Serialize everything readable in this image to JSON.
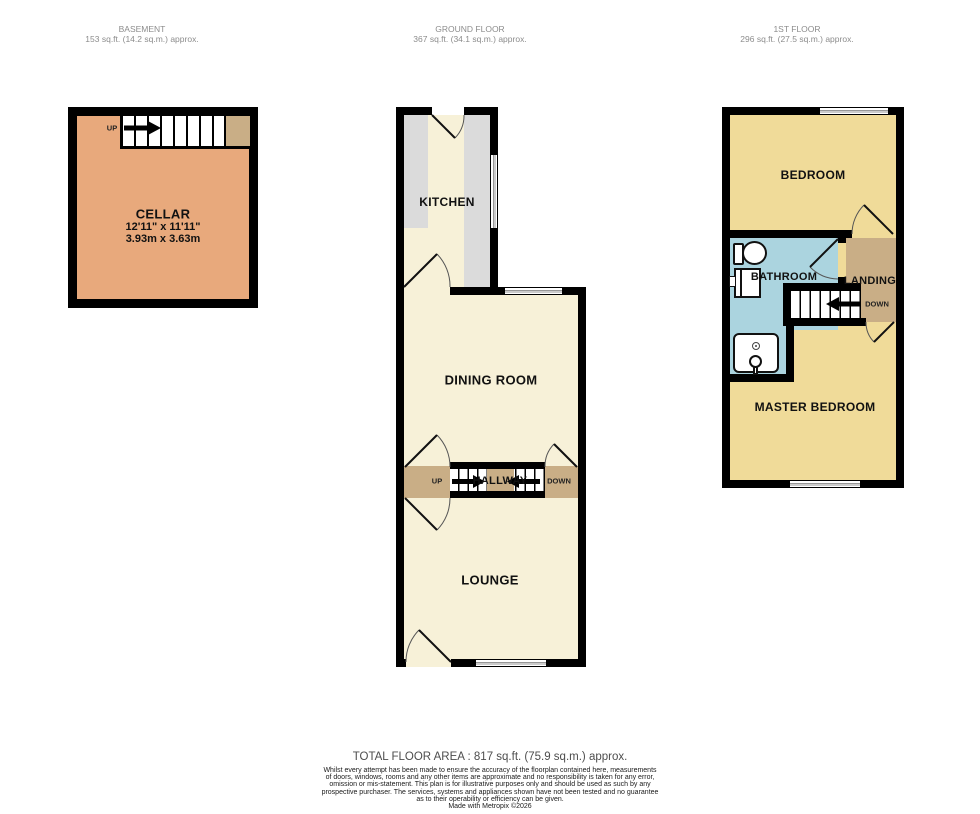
{
  "document": {
    "type": "estate-agent-floorplan",
    "floors_count": 3
  },
  "palette": {
    "wall": "#000000",
    "cellar_floor": "#e8a97c",
    "cream_floor": "#f7f1d8",
    "tan_landing": "#c9ae86",
    "bedroom_yellow": "#f0db99",
    "bathroom_blue": "#abd4df",
    "counter_gray": "#dbdbdb",
    "header_text": "#8c8c8c"
  },
  "floors": {
    "basement": {
      "title": "BASEMENT",
      "area": "153 sq.ft. (14.2 sq.m.) approx.",
      "cellar_name": "CELLAR",
      "cellar_dims_imperial": "12'11\" x 11'11\"",
      "cellar_dims_metric": "3.93m  x 3.63m",
      "stair_label": "UP"
    },
    "ground": {
      "title": "GROUND FLOOR",
      "area": "367 sq.ft. (34.1 sq.m.) approx.",
      "kitchen": "KITCHEN",
      "dining_room": "DINING ROOM",
      "hallway": "HALLWAY",
      "lounge": "LOUNGE",
      "stair_up": "UP",
      "stair_down": "DOWN"
    },
    "first": {
      "title": "1ST FLOOR",
      "area": "296 sq.ft. (27.5 sq.m.) approx.",
      "bedroom": "BEDROOM",
      "bathroom": "BATHROOM",
      "landing": "LANDING",
      "master_bedroom": "MASTER BEDROOM",
      "stair_down": "DOWN"
    }
  },
  "footer": {
    "total_area": "TOTAL FLOOR AREA : 817 sq.ft. (75.9 sq.m.) approx.",
    "disclaimer_lines": [
      "Whilst every attempt has been made to ensure the accuracy of the floorplan contained here, measurements",
      "of doors, windows, rooms and any other items are approximate and no responsibility is taken for any error,",
      "omission or mis-statement. This plan is for illustrative purposes only and should be used as such by any",
      "prospective purchaser. The services, systems and appliances shown have not been tested and no guarantee",
      "as to their operability or efficiency can be given."
    ],
    "credit": "Made with Metropix ©2026"
  }
}
